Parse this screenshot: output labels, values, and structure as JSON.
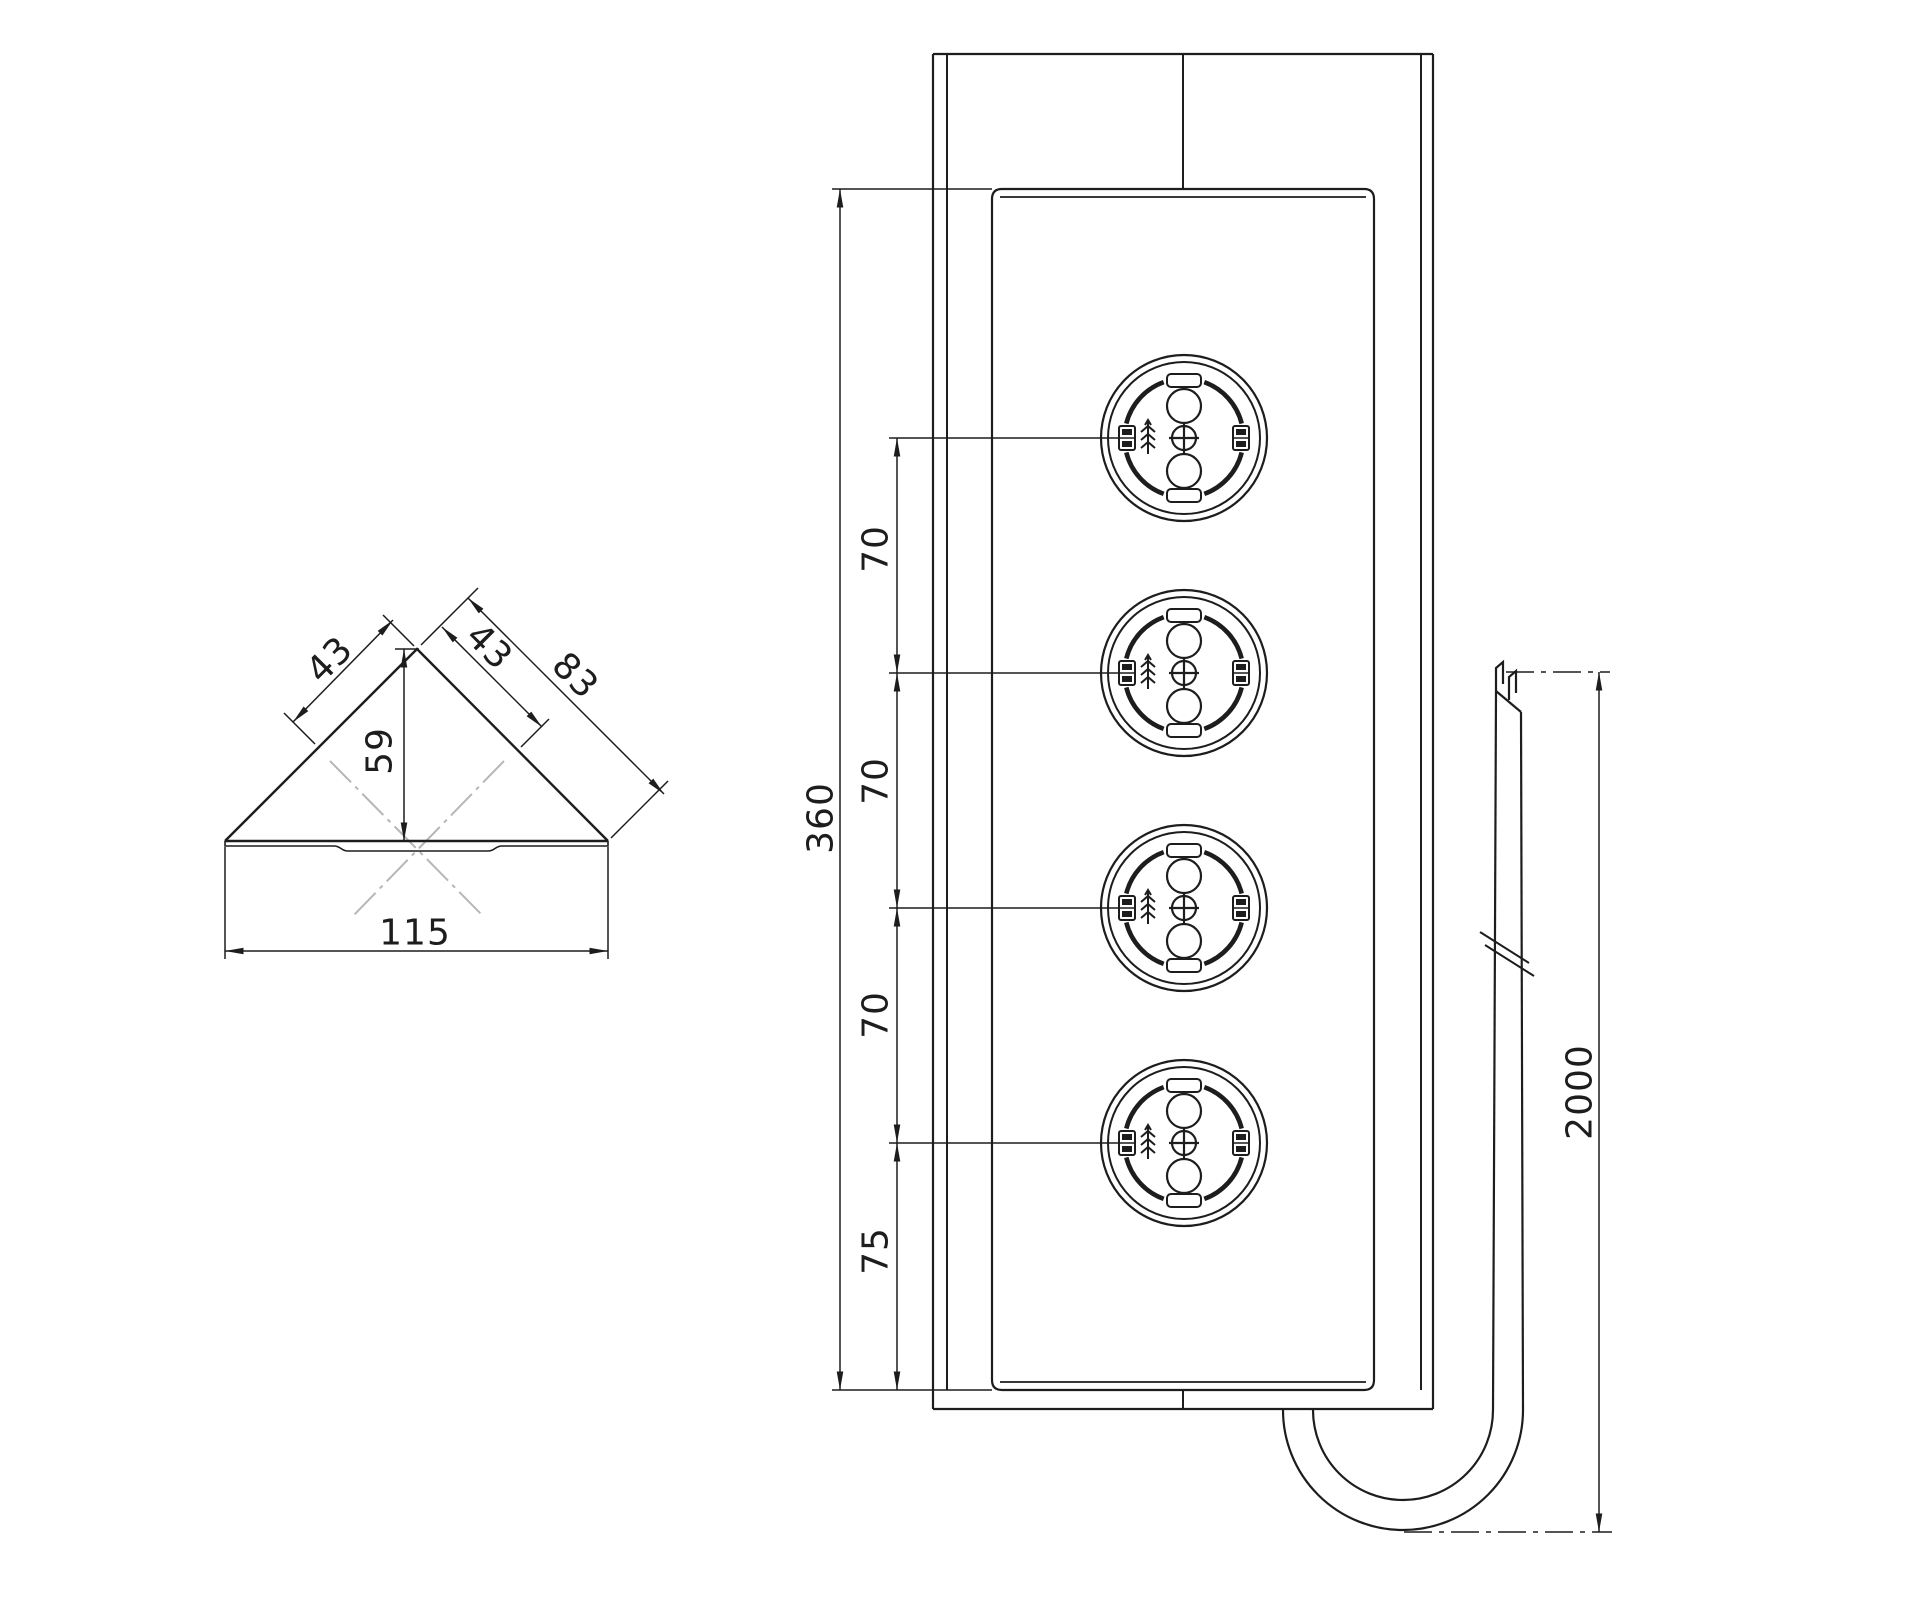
{
  "colors": {
    "line": "#1d1d1d",
    "phantom": "#b6b6b6",
    "background": "#ffffff"
  },
  "views": {
    "corner_profile": {
      "dim_slope_left": "43",
      "dim_slope_right_inner": "43",
      "dim_slope_right_outer": "83",
      "dim_apex_to_base": "59",
      "dim_base_width": "115"
    },
    "front": {
      "dim_faceplate_height": "360",
      "dim_socket_pitch_a": "70",
      "dim_socket_pitch_b": "70",
      "dim_socket_pitch_c": "70",
      "dim_bottom_socket_offset": "75",
      "socket_count": 4
    },
    "cable": {
      "dim_length": "2000"
    }
  }
}
